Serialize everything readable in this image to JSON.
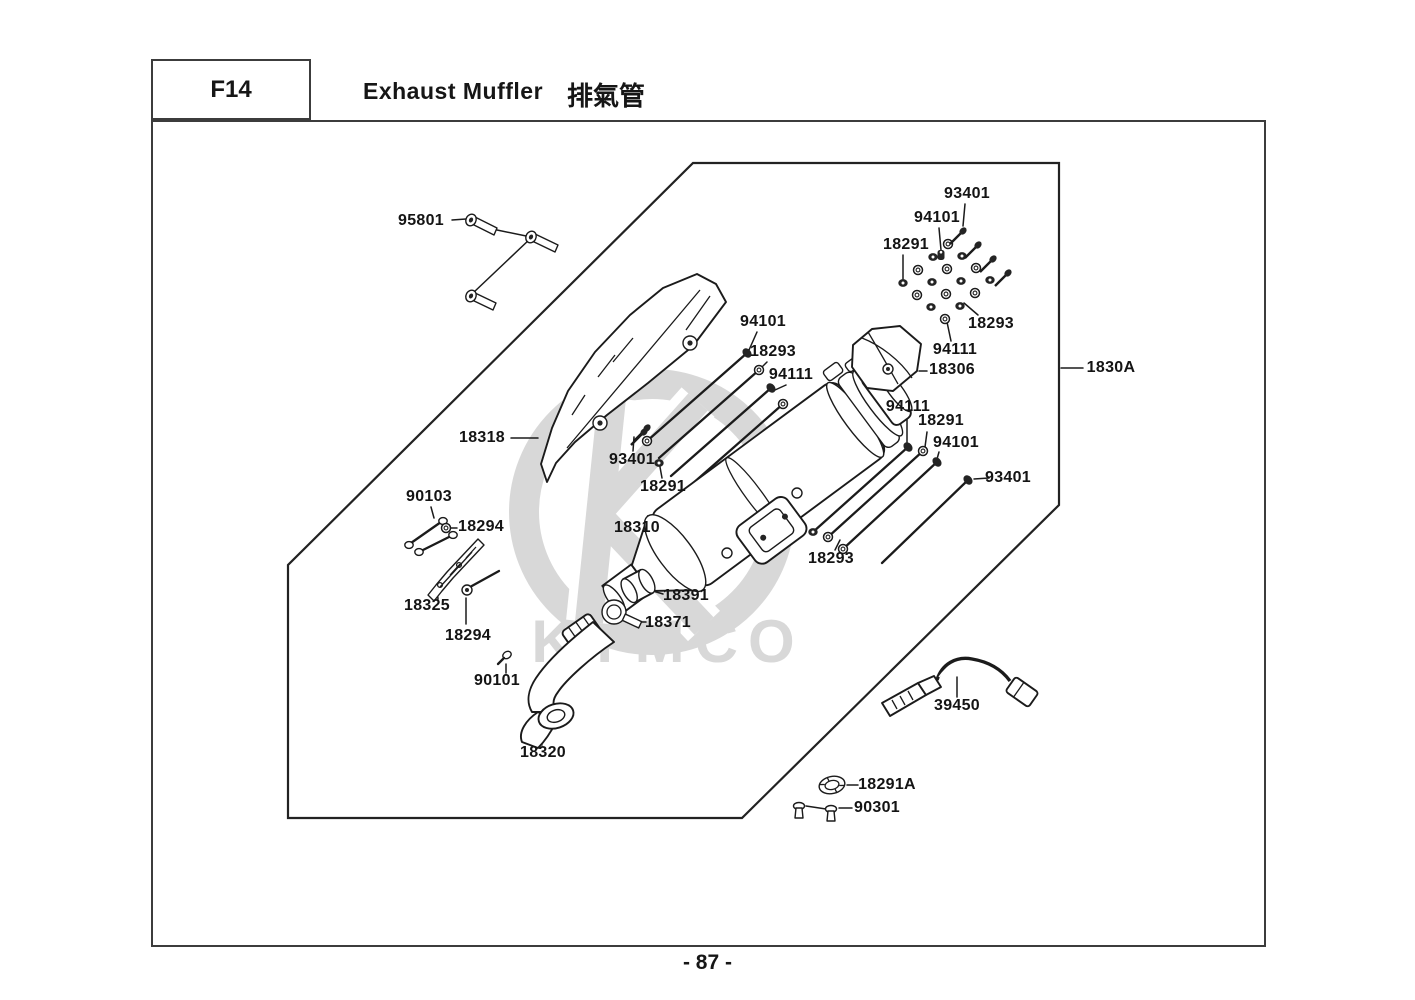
{
  "header": {
    "code": "F14",
    "title_en": "Exhaust Muffler",
    "title_zh": "排氣管"
  },
  "watermark": {
    "brand": "KYMCO"
  },
  "footer": {
    "page_number": "- 87 -"
  },
  "diagram": {
    "assembly_ref": "1830A",
    "labels": [
      {
        "text": "95801",
        "x": 421,
        "y": 221
      },
      {
        "text": "93401",
        "x": 967,
        "y": 194
      },
      {
        "text": "94101",
        "x": 937,
        "y": 218
      },
      {
        "text": "18291",
        "x": 906,
        "y": 245
      },
      {
        "text": "18293",
        "x": 991,
        "y": 324
      },
      {
        "text": "94111",
        "x": 955,
        "y": 350
      },
      {
        "text": "18306",
        "x": 952,
        "y": 370
      },
      {
        "text": "1830A",
        "x": 1111,
        "y": 368
      },
      {
        "text": "94101",
        "x": 763,
        "y": 322
      },
      {
        "text": "18293",
        "x": 773,
        "y": 352
      },
      {
        "text": "94111",
        "x": 791,
        "y": 375
      },
      {
        "text": "18318",
        "x": 482,
        "y": 438
      },
      {
        "text": "93401",
        "x": 632,
        "y": 460
      },
      {
        "text": "18291",
        "x": 663,
        "y": 487
      },
      {
        "text": "90103",
        "x": 429,
        "y": 497
      },
      {
        "text": "18294",
        "x": 481,
        "y": 527
      },
      {
        "text": "18310",
        "x": 637,
        "y": 528
      },
      {
        "text": "94111",
        "x": 908,
        "y": 407
      },
      {
        "text": "18291",
        "x": 941,
        "y": 421
      },
      {
        "text": "94101",
        "x": 956,
        "y": 443
      },
      {
        "text": "93401",
        "x": 1008,
        "y": 478
      },
      {
        "text": "18293",
        "x": 831,
        "y": 559
      },
      {
        "text": "18325",
        "x": 427,
        "y": 606
      },
      {
        "text": "18294",
        "x": 468,
        "y": 636
      },
      {
        "text": "18391",
        "x": 686,
        "y": 596
      },
      {
        "text": "18371",
        "x": 668,
        "y": 623
      },
      {
        "text": "90101",
        "x": 497,
        "y": 681
      },
      {
        "text": "18320",
        "x": 543,
        "y": 753
      },
      {
        "text": "39450",
        "x": 957,
        "y": 706
      },
      {
        "text": "18291A",
        "x": 887,
        "y": 785
      },
      {
        "text": "90301",
        "x": 877,
        "y": 808
      }
    ]
  }
}
